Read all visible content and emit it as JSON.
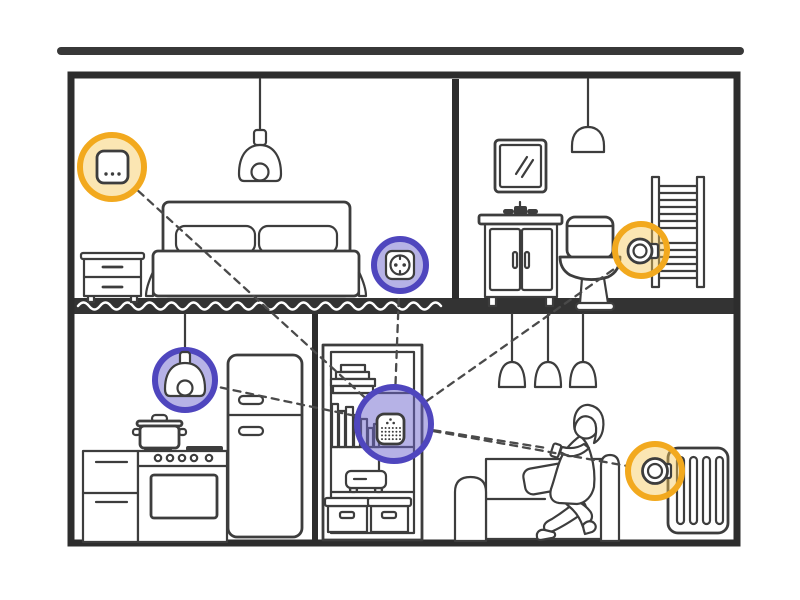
{
  "scene": {
    "title": "Smart home cross-section illustration",
    "storeys": 2,
    "palette": {
      "background": "#ffffff",
      "ink": "#3d3d3d",
      "frame": "#2d2d2d",
      "floor_band": "#333333",
      "wave": "#ffffff",
      "dash_line": "#4a4a4a",
      "yellow_ring": "#F2A91E",
      "yellow_fill": "rgba(246,199,87,0.45)",
      "purple_ring": "#4F46BE",
      "purple_fill": "rgba(110,102,205,0.5)"
    },
    "rooms": [
      {
        "name": "bedroom",
        "floor": "upper",
        "items": [
          "pendant lamp",
          "double bed",
          "two pillows",
          "nightstand",
          "smart switch",
          "smart plug socket"
        ]
      },
      {
        "name": "bathroom",
        "floor": "upper",
        "items": [
          "mirror",
          "pendant lamp",
          "vanity sink",
          "toilet",
          "towel radiator",
          "radiator thermostat"
        ]
      },
      {
        "name": "kitchen",
        "floor": "ground",
        "items": [
          "pendant smart bulb",
          "cooking pot",
          "stove with oven",
          "drawer cabinet",
          "fridge"
        ]
      },
      {
        "name": "living-room",
        "floor": "ground",
        "items": [
          "bookshelf",
          "smart hub",
          "wifi router",
          "storage boxes",
          "three pendant lamps",
          "sofa",
          "woman with smartphone",
          "radiator",
          "radiator thermostat"
        ]
      }
    ],
    "nodes": [
      {
        "id": "hub",
        "label": "smart-hub",
        "x": 394,
        "y": 424,
        "r": 37,
        "highlight": "purple"
      },
      {
        "id": "switch",
        "label": "smart-switch",
        "x": 112,
        "y": 167,
        "r": 32,
        "highlight": "yellow"
      },
      {
        "id": "plug",
        "label": "smart-plug-socket",
        "x": 400,
        "y": 265,
        "r": 26,
        "highlight": "purple"
      },
      {
        "id": "bath-valve",
        "label": "bathroom-radiator-thermostat",
        "x": 641,
        "y": 250,
        "r": 26,
        "highlight": "yellow"
      },
      {
        "id": "bulb",
        "label": "kitchen-pendant-bulb",
        "x": 185,
        "y": 380,
        "r": 30,
        "highlight": "purple"
      },
      {
        "id": "living-valve",
        "label": "living-room-radiator-thermostat",
        "x": 655,
        "y": 471,
        "r": 27,
        "highlight": "yellow"
      },
      {
        "id": "phone",
        "label": "smartphone",
        "x": 559,
        "y": 450,
        "r": 9,
        "highlight": "none"
      }
    ],
    "connections": [
      [
        "hub",
        "switch"
      ],
      [
        "hub",
        "plug"
      ],
      [
        "hub",
        "bath-valve"
      ],
      [
        "hub",
        "bulb"
      ],
      [
        "hub",
        "living-valve"
      ],
      [
        "hub",
        "phone"
      ]
    ],
    "wave": {
      "x0": 78,
      "x1": 450,
      "y": 306,
      "half_period": 11,
      "amplitude": 7
    }
  }
}
